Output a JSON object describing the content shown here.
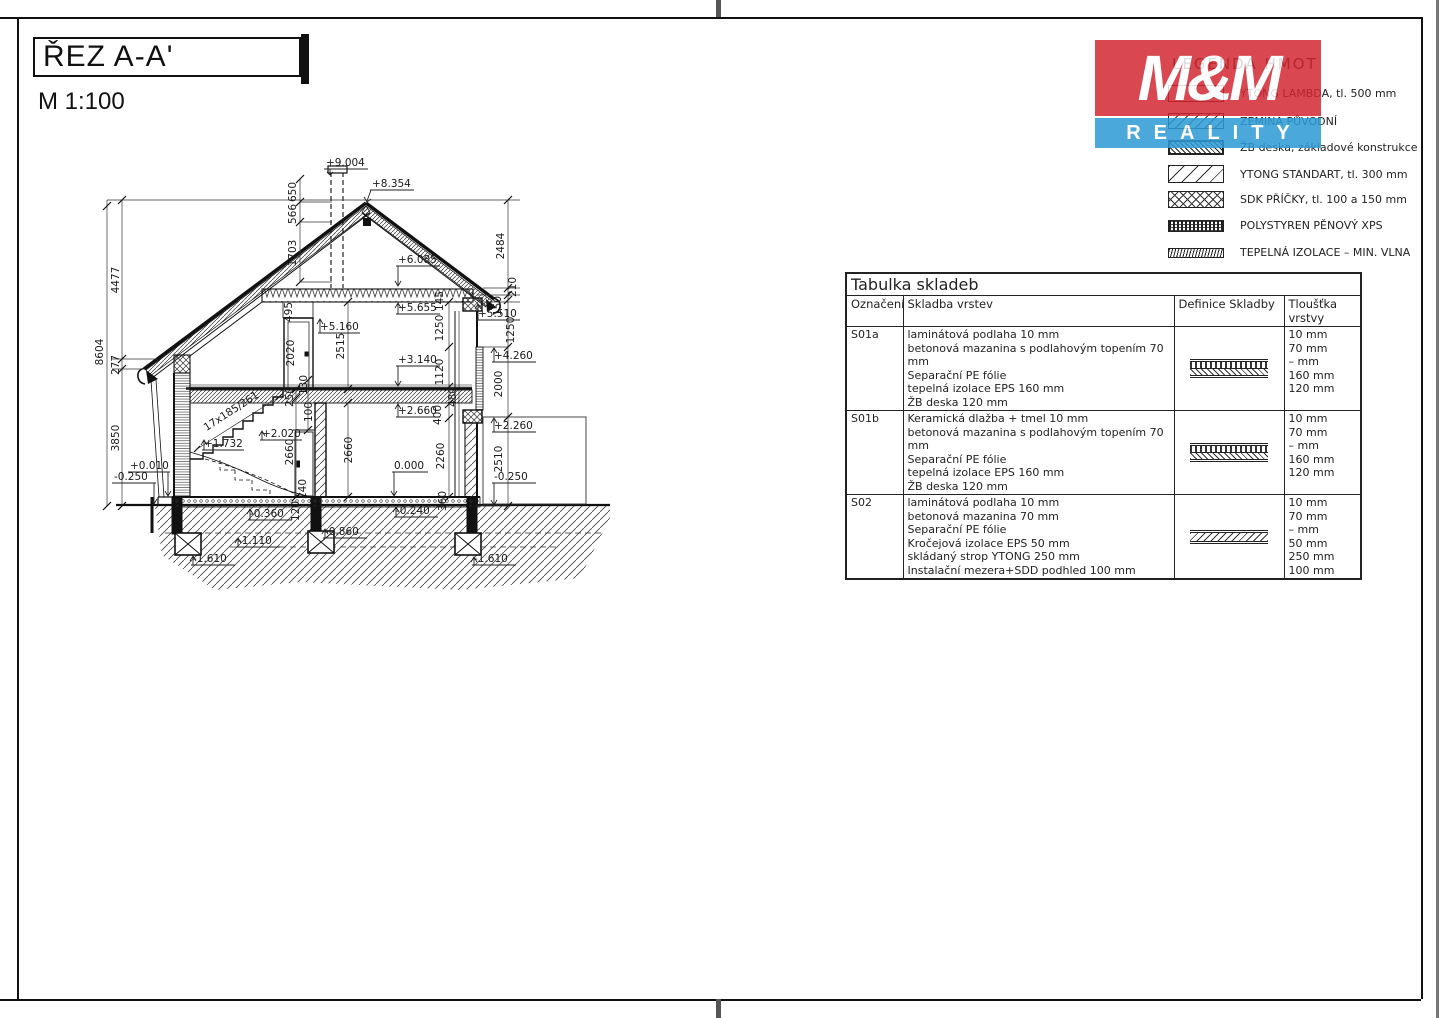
{
  "page": {
    "title": "ŘEZ A-A'",
    "scale": "M 1:100"
  },
  "logo": {
    "top": "M&M",
    "bottom": "REALITY",
    "red": "#d22630",
    "blue": "#2d9bd5"
  },
  "legend": {
    "title": "LEGENDA HMOT",
    "items": [
      {
        "pattern": "ytong-lambda-empty",
        "label": "YTONG LAMBDA, tl. 500 mm"
      },
      {
        "pattern": "zemina-diagonal",
        "label": "ZEMINA PŮVODNÍ"
      },
      {
        "pattern": "zb-dense-diagonal",
        "label": "ŽB deska, základové konstrukce"
      },
      {
        "pattern": "ytong-diagonal",
        "label": "YTONG STANDART, tl. 300 mm"
      },
      {
        "pattern": "sdk-crosshatch",
        "label": "SDK PŘÍČKY, tl. 100 a 150 mm"
      },
      {
        "pattern": "xps-dense",
        "label": "POLYSTYREN PĚNOVÝ XPS"
      },
      {
        "pattern": "mineral-wool-zigzag",
        "label": "TEPELNÁ IZOLACE – MIN. VLNA"
      }
    ]
  },
  "table": {
    "title": "Tabulka skladeb",
    "headers": [
      "Označení",
      "Skladba vrstev",
      "Definice Skladby",
      "Tloušťka vrstvy"
    ],
    "rows": [
      {
        "id": "S01a",
        "layers": [
          "laminátová podlaha 10 mm",
          "betonová mazanina s podlahovým topením 70 mm",
          "Separační PE fólie",
          "tepelná izolace EPS 160 mm",
          "ŽB deska 120 mm"
        ],
        "thicknesses": [
          "10 mm",
          "70 mm",
          "– mm",
          "160 mm",
          "120 mm"
        ]
      },
      {
        "id": "S01b",
        "layers": [
          "Keramická dlažba + tmel 10 mm",
          "betonová mazanina s podlahovým topením 70 mm",
          "Separační PE fólie",
          "tepelná izolace EPS 160 mm",
          "ŽB deska 120 mm"
        ],
        "thicknesses": [
          "10 mm",
          "70 mm",
          "– mm",
          "160 mm",
          "120 mm"
        ]
      },
      {
        "id": "S02",
        "layers": [
          "laminátová podlaha 10 mm",
          "betonová mazanina 70 mm",
          "Separační PE fólie",
          "Kročejová izolace EPS 50 mm",
          "skládaný strop YTONG 250 mm",
          "Instalační mezera+SDD podhled 100 mm"
        ],
        "thicknesses": [
          "10 mm",
          "70 mm",
          "– mm",
          "50 mm",
          "250 mm",
          "100 mm"
        ]
      }
    ]
  },
  "drawing": {
    "stair_label": "17x185/261",
    "levels": [
      {
        "text": "+9.004"
      },
      {
        "text": "+8.354"
      },
      {
        "text": "+6.085"
      },
      {
        "text": "+5.655"
      },
      {
        "text": "+5.510"
      },
      {
        "text": "+5.160"
      },
      {
        "text": "+4.260"
      },
      {
        "text": "+3.140"
      },
      {
        "text": "+2.660"
      },
      {
        "text": "+2.260"
      },
      {
        "text": "+2.020"
      },
      {
        "text": "+1.732"
      },
      {
        "text": "0.000"
      },
      {
        "text": "+0.010"
      },
      {
        "text": "-0.250"
      },
      {
        "text": "-0.250"
      },
      {
        "text": "-0.360"
      },
      {
        "text": "-0.240"
      },
      {
        "text": "-0.860"
      },
      {
        "text": "-1.110"
      },
      {
        "text": "-1.610"
      },
      {
        "text": "-1.610"
      }
    ],
    "dims": [
      {
        "text": "8604"
      },
      {
        "text": "4477"
      },
      {
        "text": "277"
      },
      {
        "text": "3850"
      },
      {
        "text": "650"
      },
      {
        "text": "566"
      },
      {
        "text": "1703"
      },
      {
        "text": "2484"
      },
      {
        "text": "210"
      },
      {
        "text": "150"
      },
      {
        "text": "145"
      },
      {
        "text": "495"
      },
      {
        "text": "2020"
      },
      {
        "text": "2515"
      },
      {
        "text": "1250"
      },
      {
        "text": "1250"
      },
      {
        "text": "1120"
      },
      {
        "text": "2000"
      },
      {
        "text": "250"
      },
      {
        "text": "130"
      },
      {
        "text": "100"
      },
      {
        "text": "480"
      },
      {
        "text": "400"
      },
      {
        "text": "2660"
      },
      {
        "text": "2660"
      },
      {
        "text": "2260"
      },
      {
        "text": "2510"
      },
      {
        "text": "240"
      },
      {
        "text": "120"
      },
      {
        "text": "360"
      }
    ]
  }
}
